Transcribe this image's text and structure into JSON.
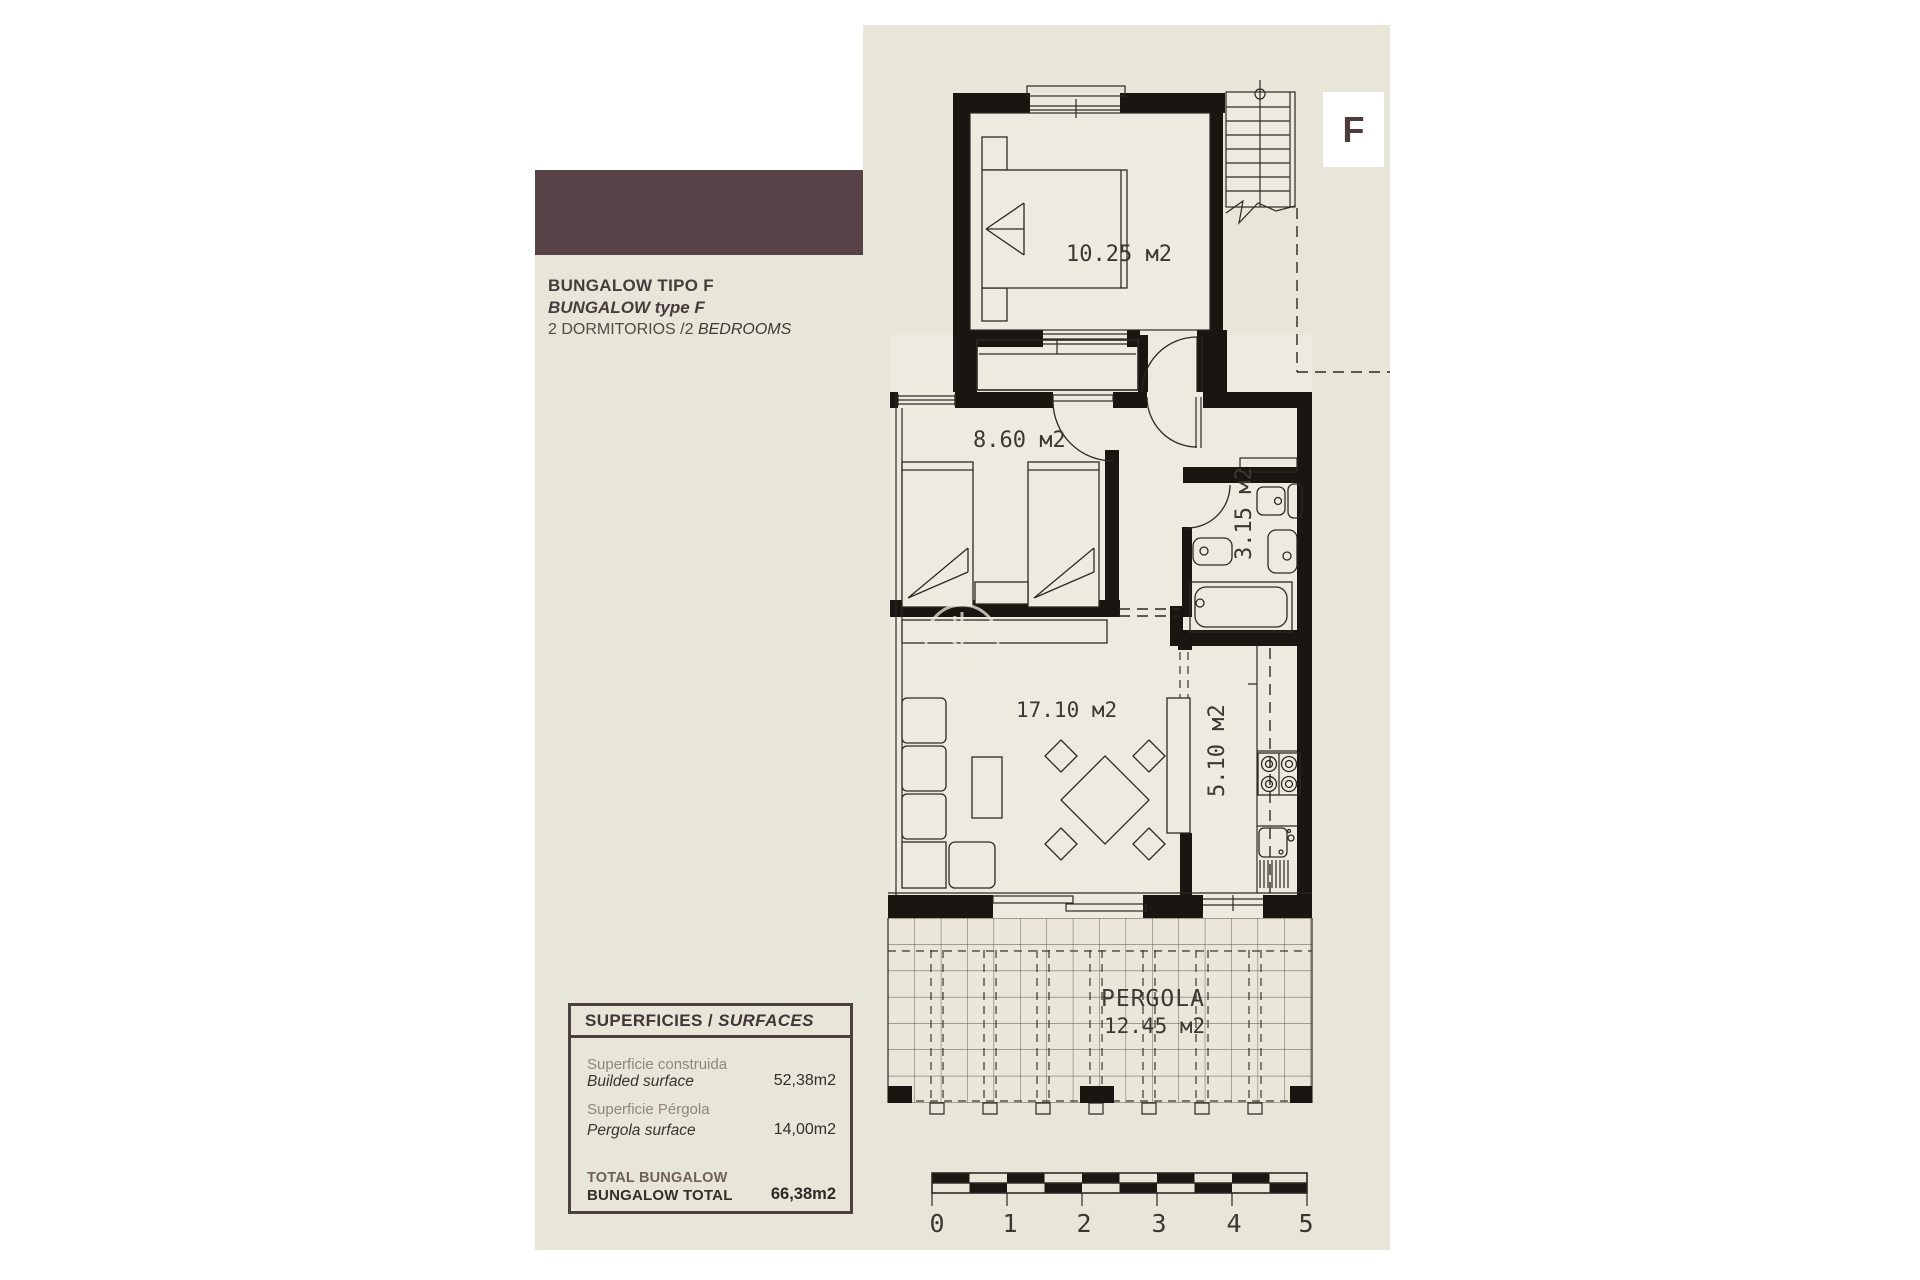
{
  "header": {
    "marker_letter": "F",
    "title_line1": "BUNGALOW TIPO F",
    "title_line2": "BUNGALOW type F",
    "title_line3_regular": "2 DORMITORIOS /2 ",
    "title_line3_italic": "BEDROOMS"
  },
  "colors": {
    "panel_beige": "#e8e5d9",
    "brand_brown": "#564247",
    "wall_black": "#191511",
    "room_fill": "#edebdf"
  },
  "plan": {
    "bedroom1_area": "10.25 м2",
    "bedroom2_area": "8.60 м2",
    "bathroom_area": "3.15 м2",
    "living_area": "17.10 м2",
    "kitchen_area": "5.10 м2",
    "pergola_title": "PERGOLA",
    "pergola_area": "12.45 м2",
    "scale": [
      "0",
      "1",
      "2",
      "3",
      "4",
      "5"
    ]
  },
  "surfaces": {
    "header_regular": "SUPERFICIES / ",
    "header_italic": "SURFACES",
    "rows": [
      {
        "label_es": "Superficie construida",
        "label_en": "Builded surface",
        "value": "52,38m2"
      },
      {
        "label_es": "Superficie Pérgola",
        "label_en": "Pergola surface",
        "value": "14,00m2"
      }
    ],
    "total": {
      "label_line1": "TOTAL BUNGALOW",
      "label_line2": "BUNGALOW TOTAL",
      "value": "66,38m2"
    }
  }
}
